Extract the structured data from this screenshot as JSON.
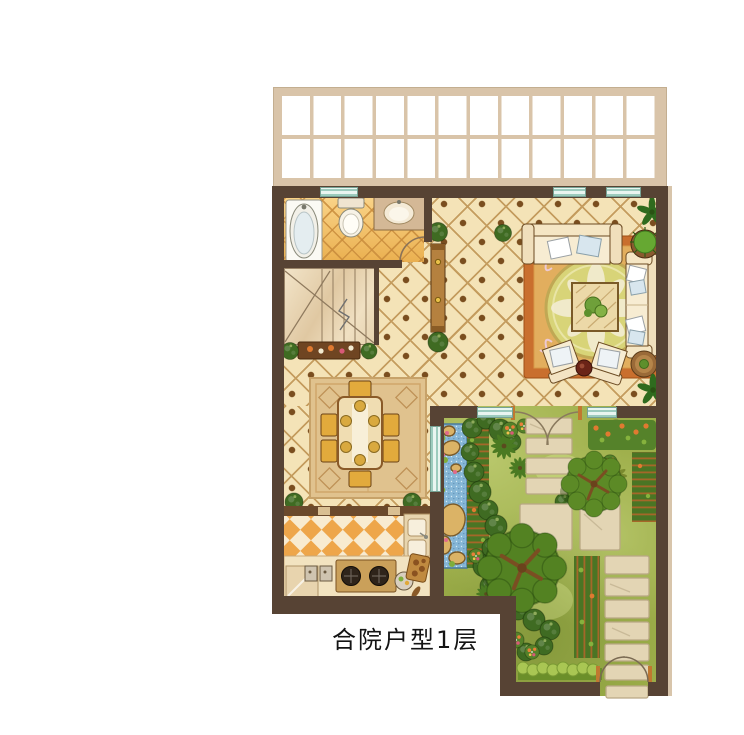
{
  "caption": {
    "text": "合院户型1层"
  },
  "palette": {
    "wall": "#574334",
    "pergola": "#d9c4a9",
    "hall": "#f4e3b7",
    "tileline": "#c49c5e",
    "bathtile": "#f2bc60",
    "korange": "#eea64a",
    "kcream": "#f8ebd0",
    "grass": "#9dae49",
    "water": "#85b6d6",
    "stone": "#e3d5b4",
    "rugliving": "#c96f2e",
    "rugdining": "#e0c28e",
    "sofa": "#f3e3c3",
    "wood": "#b5813f",
    "window": "#bfe0d6",
    "treedark": "#5c8a26",
    "trellis": "#b5652a"
  },
  "legend": {
    "areas": [
      "pergola-canopy",
      "bathroom",
      "staircase",
      "hallway",
      "living-room",
      "dining-room",
      "kitchen",
      "courtyard-garden"
    ],
    "items": [
      "bathtub",
      "toilet",
      "sink-vanity",
      "sofa",
      "loveseat",
      "armchairs",
      "coffee-table",
      "round-rug",
      "dining-table",
      "stove",
      "kitchen-sink",
      "fridge-counter",
      "pond",
      "stepping-stones",
      "trees",
      "hedges",
      "garden-gate"
    ]
  }
}
